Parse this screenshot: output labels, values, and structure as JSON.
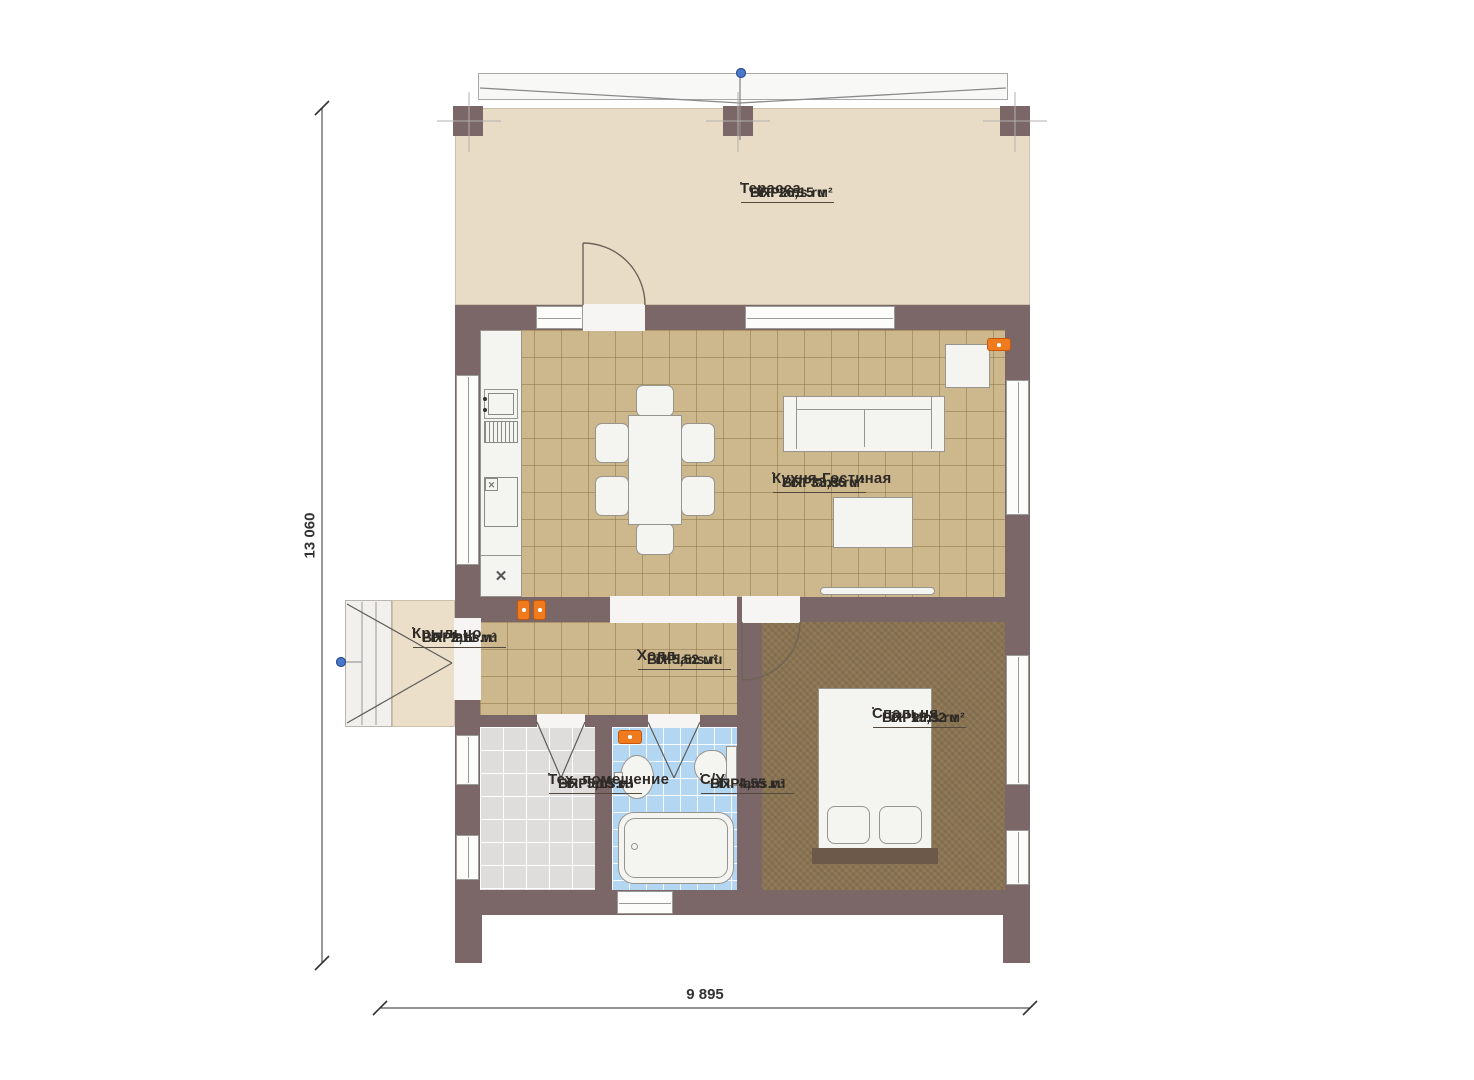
{
  "rooms": [
    {
      "name": "Терасса",
      "brand": "FixPlans.ru",
      "area": "ВП: 26,15 м²"
    },
    {
      "name": "Кухня-Гостиная",
      "brand": "FixPlans.ru",
      "area": "ВП: 33,66 м²"
    },
    {
      "name": "Крыльцо",
      "brand": "FixPlans.ru",
      "area": "ВП: 2,11 м²"
    },
    {
      "name": "Холл",
      "brand": "FixPlans.ru",
      "area": "ВП:5,52 м²"
    },
    {
      "name": "Спальня",
      "brand": "FixPlans.ru",
      "area": "ВП: 15,52 м²"
    },
    {
      "name": "Тех. помещение",
      "brand": "FixPlans.ru",
      "area": "ВП: 5,15 м²"
    },
    {
      "name": "С/У",
      "brand": "FixPlans.ru",
      "area": "ВП: 4,55 м²"
    }
  ],
  "dimensions": {
    "vertical": "13 060",
    "horizontal": "9 895"
  },
  "colors": {
    "wall": "#7b6768",
    "terrace_floor": "#e8dcc7",
    "tile_floor": "#cdb88d",
    "bedroom_floor": "#8a7452",
    "tech_floor": "#dedddb",
    "bath_floor": "#b3d7f3",
    "marker_orange": "#f07a1e",
    "axis_blue": "#4a79cc"
  }
}
